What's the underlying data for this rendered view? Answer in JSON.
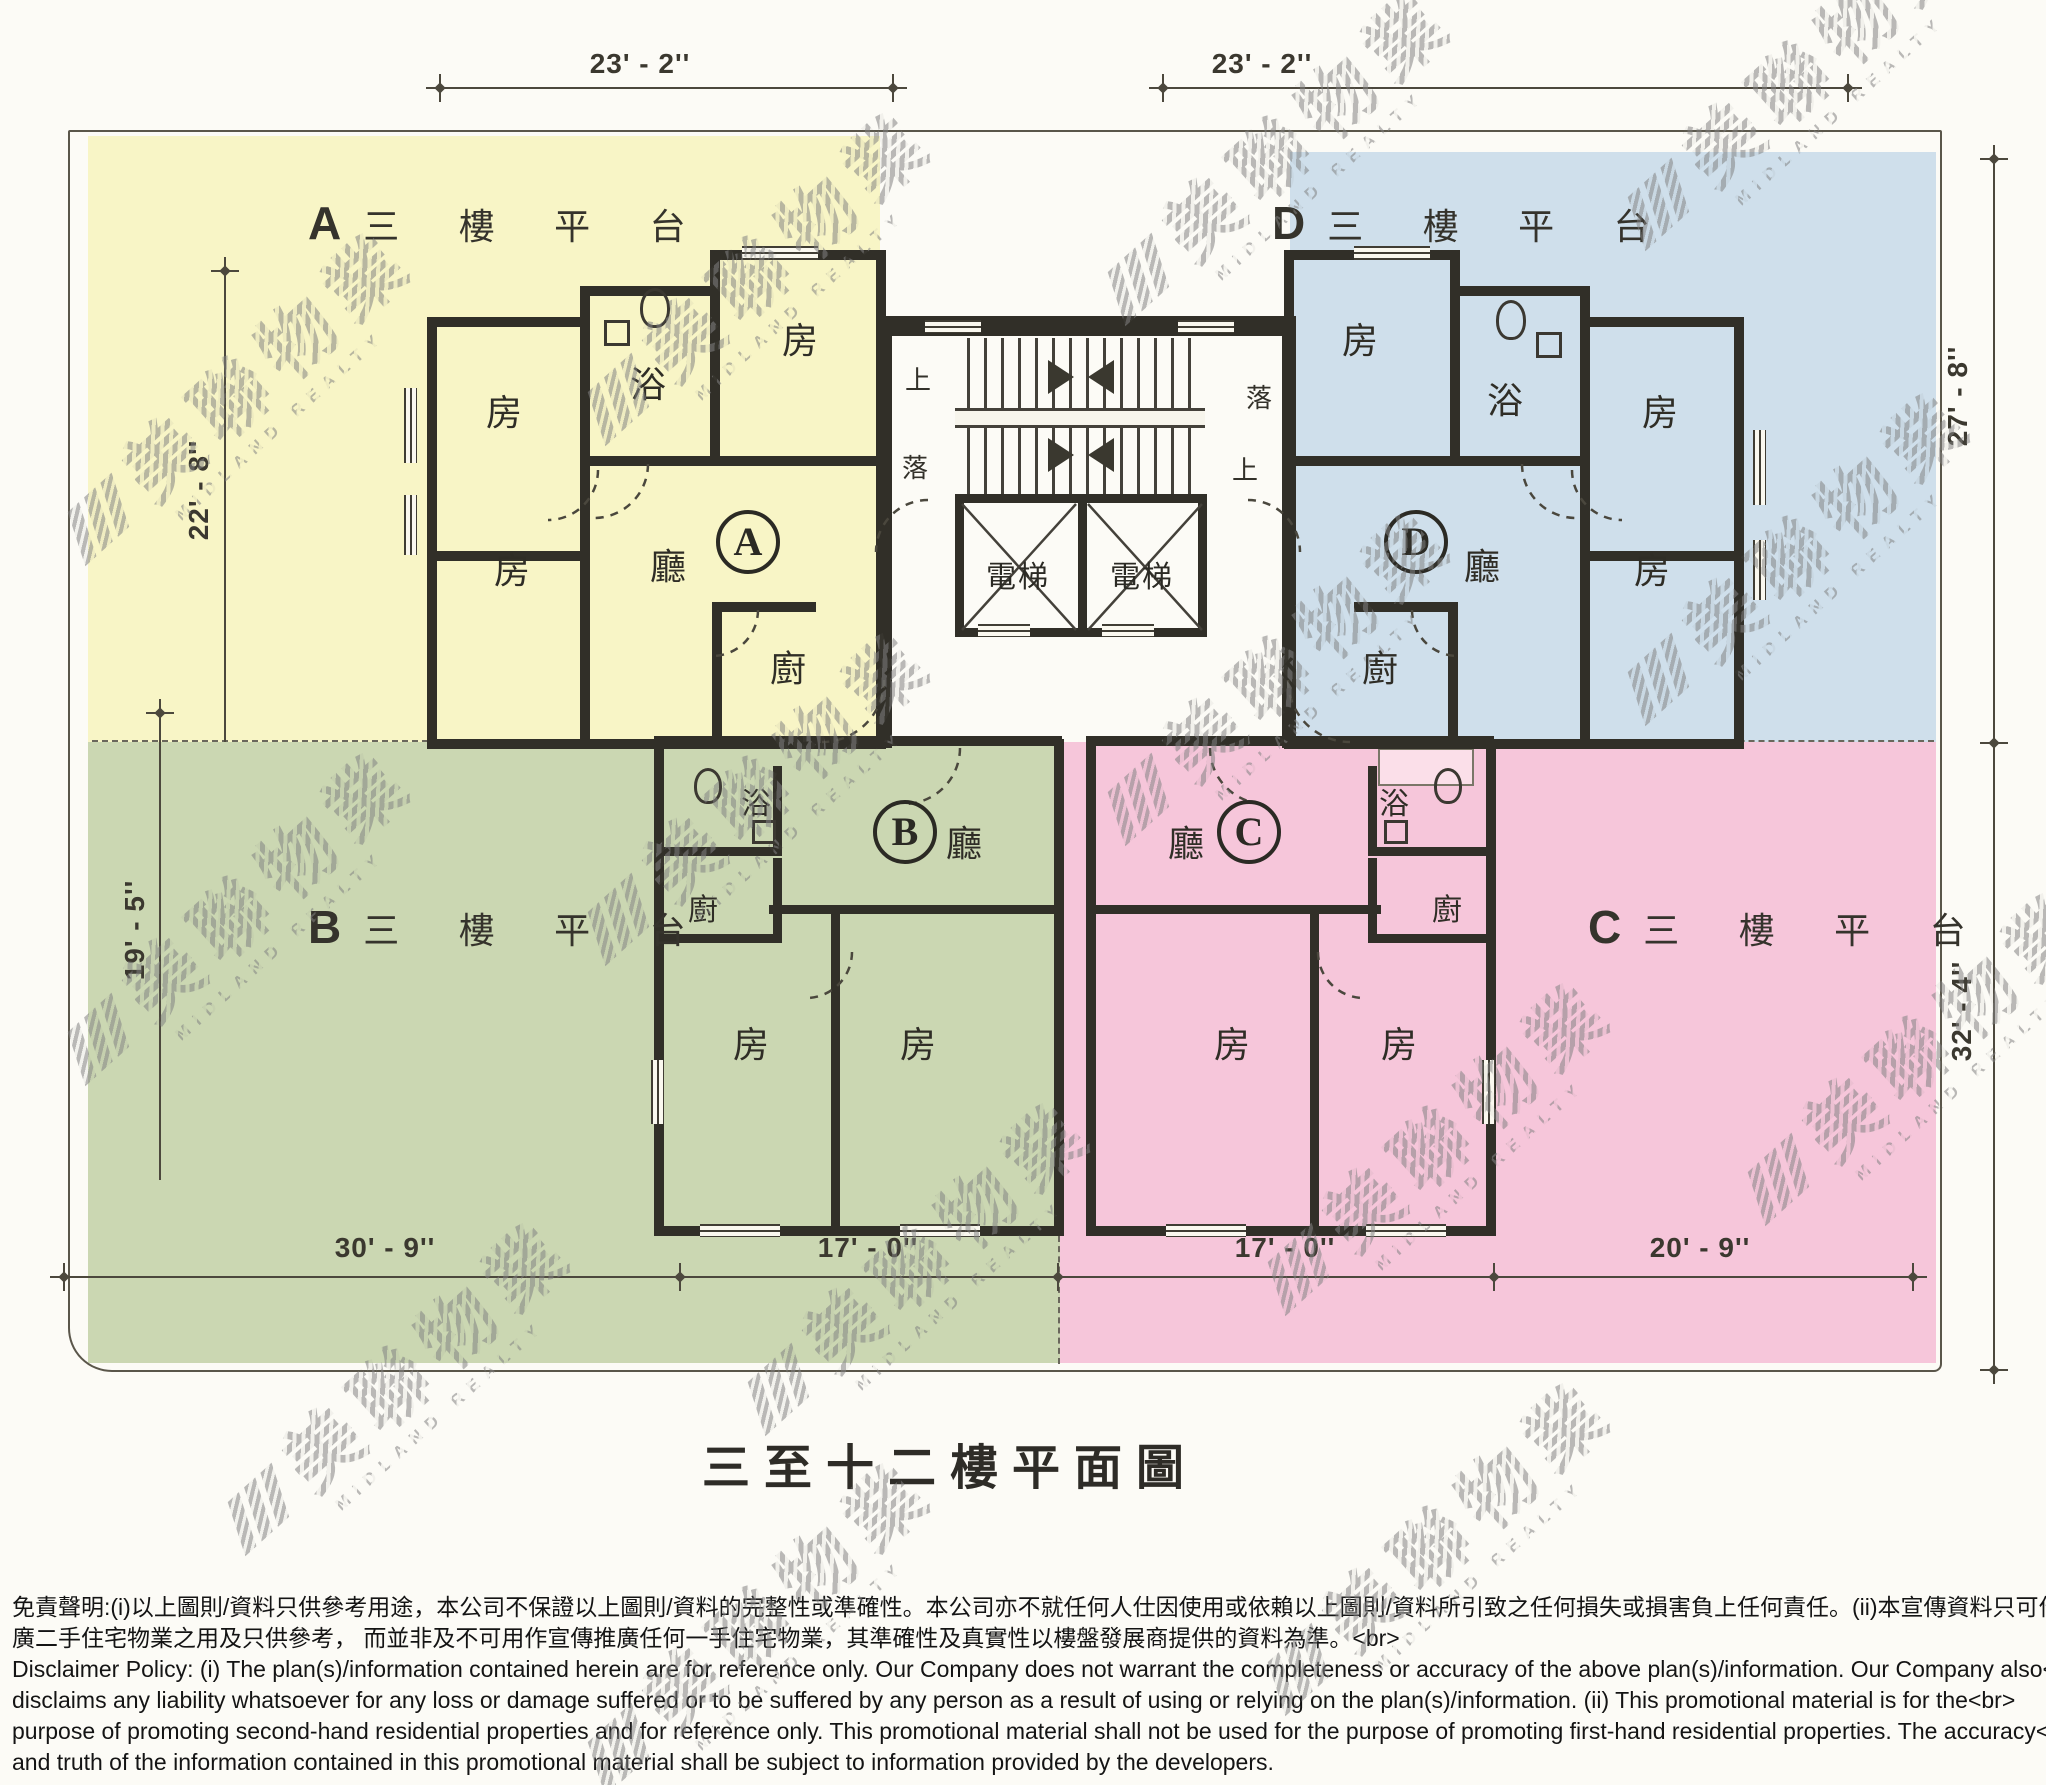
{
  "page": {
    "title": "三至十二樓平面圖"
  },
  "watermark": {
    "cjk": "美聯物業",
    "latin": "MIDLAND REALTY"
  },
  "units": {
    "A": {
      "id": "A",
      "terrace_label": "三 樓 平 台",
      "living": "廳",
      "kitchen": "廚",
      "bath": "浴",
      "bedroom1": "房",
      "bedroom2": "房",
      "bedroom3": "房"
    },
    "B": {
      "id": "B",
      "terrace_label": "三 樓 平 台",
      "living": "廳",
      "kitchen": "廚",
      "bath": "浴",
      "bedroom1": "房",
      "bedroom2": "房"
    },
    "C": {
      "id": "C",
      "terrace_label": "三 樓 平 台",
      "living": "廳",
      "kitchen": "廚",
      "bath": "浴",
      "bedroom1": "房",
      "bedroom2": "房"
    },
    "D": {
      "id": "D",
      "terrace_label": "三 樓 平 台",
      "living": "廳",
      "kitchen": "廚",
      "bath": "浴",
      "bedroom1": "房",
      "bedroom2": "房",
      "bedroom3": "房"
    }
  },
  "core": {
    "elevator_left": "電梯",
    "elevator_right": "電梯",
    "stair_up_left": "上",
    "stair_down_left": "落",
    "stair_down_right": "落",
    "stair_up_right": "上"
  },
  "dimensions": {
    "top_left": "23' - 2''",
    "top_right": "23' - 2''",
    "left_upper": "22' - 8''",
    "left_lower": "19' - 5''",
    "right_upper": "27' - 8''",
    "right_lower": "32' - 4''",
    "bottom_1": "30' - 9''",
    "bottom_2": "17' - 0''",
    "bottom_3": "17' - 0''",
    "bottom_4": "20' - 9''"
  },
  "disclaimer": {
    "lines": [
      "免責聲明:(i)以上圖則/資料只供參考用途，本公司不保證以上圖則/資料的完整性或準確性。本公司亦不就任何人仕因使用或依賴以上圖則/資料所引致之任何損失或損害負上任何責任。(ii)本宣傳資料只可作宣傳及推<br>",
      "廣二手住宅物業之用及只供參考， 而並非及不可用作宣傳推廣任何一手住宅物業，其準確性及真實性以樓盤發展商提供的資料為準。<br>",
      "Disclaimer Policy: (i) The plan(s)/information contained herein are for reference only. Our Company does not warrant the completeness or accuracy of the above plan(s)/information. Our Company also<br>",
      "disclaims any liability whatsoever for any loss or damage suffered or to be suffered by any person as a result of using or relying on the plan(s)/information. (ii) This promotional material is for the<br>",
      "purpose of promoting second-hand residential properties and for reference only. This promotional material shall not be used for the purpose of promoting first-hand residential properties. The accuracy<br>",
      "and truth of the information contained in this promotional material shall be subject to information provided by the developers."
    ]
  },
  "colors": {
    "unit_a": "#f8f5c6",
    "unit_b": "#cbd7b2",
    "unit_c": "#f6c6da",
    "unit_d": "#cfdfeb",
    "wall": "#312f28",
    "paper": "#fcfbf6"
  }
}
